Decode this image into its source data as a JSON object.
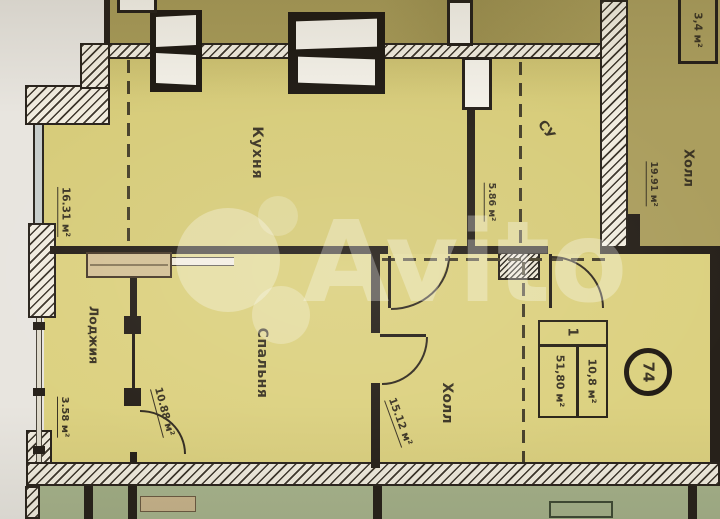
{
  "watermark": {
    "brand": "Avito"
  },
  "rooms": {
    "kitchen": {
      "name": "Кухня",
      "area": "16.31 м²"
    },
    "bathroom": {
      "name": "СУ",
      "area": "5.86 м²"
    },
    "bedroom": {
      "name": "Спальня",
      "area": "10.88 м²"
    },
    "hall": {
      "name": "Холл",
      "area": "15.12 м²"
    },
    "loggia": {
      "name": "Лоджия",
      "area": "3.58 м²"
    },
    "building_hall": {
      "name": "Холл",
      "area": "19.91 м²"
    },
    "shaft": {
      "area": "3,4 м²"
    }
  },
  "stamp": {
    "rooms_count": "1",
    "living_area": "10,8 м²",
    "total_area": "51,80 м²",
    "apartment_number": "74"
  },
  "palette": {
    "apartment_fill": "#d7cc7a",
    "upper_rooms_fill": "#a89b59",
    "lower_rooms_fill": "#a6b28b",
    "wall": "#27211a",
    "paper_background": "#e8e5df"
  }
}
